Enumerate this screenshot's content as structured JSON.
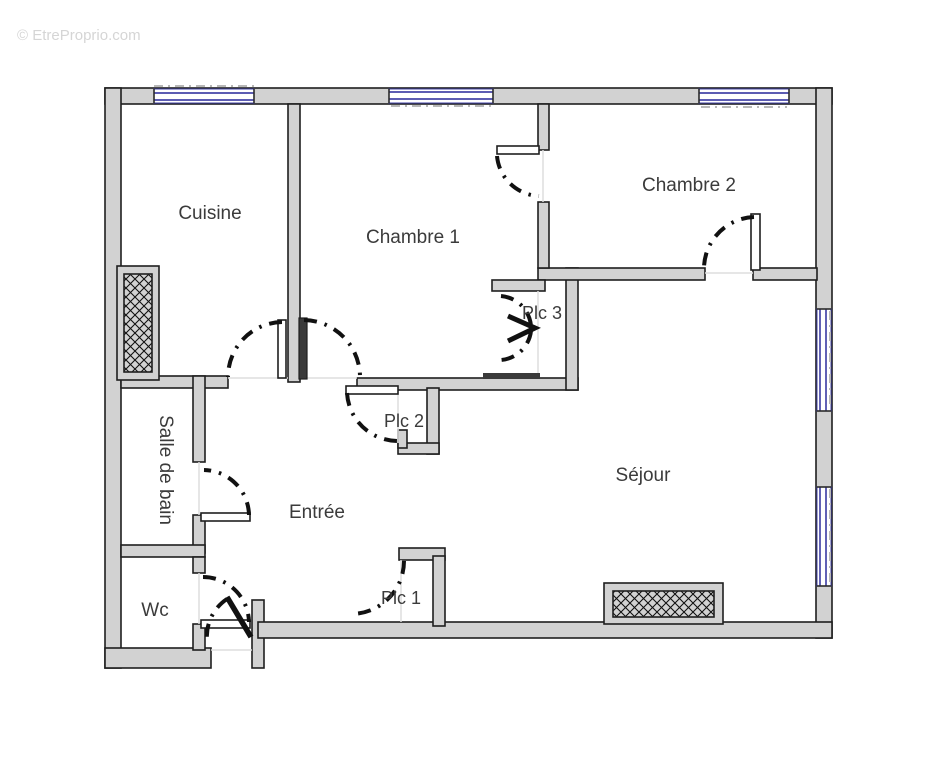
{
  "watermark": "© EtreProprio.com",
  "rooms": {
    "cuisine": "Cuisine",
    "chambre1": "Chambre 1",
    "chambre2": "Chambre 2",
    "plc1": "Plc 1",
    "plc2": "Plc 2",
    "plc3": "Plc 3",
    "entree": "Entrée",
    "sejour": "Séjour",
    "salle_de_bain": "Salle de bain",
    "wc": "Wc"
  },
  "colors": {
    "wall_fill": "#d2d2d2",
    "wall_stroke": "#1f1f1f",
    "window": "#4545a8",
    "label": "#3b3b3b",
    "watermark": "#d5d5d5"
  }
}
